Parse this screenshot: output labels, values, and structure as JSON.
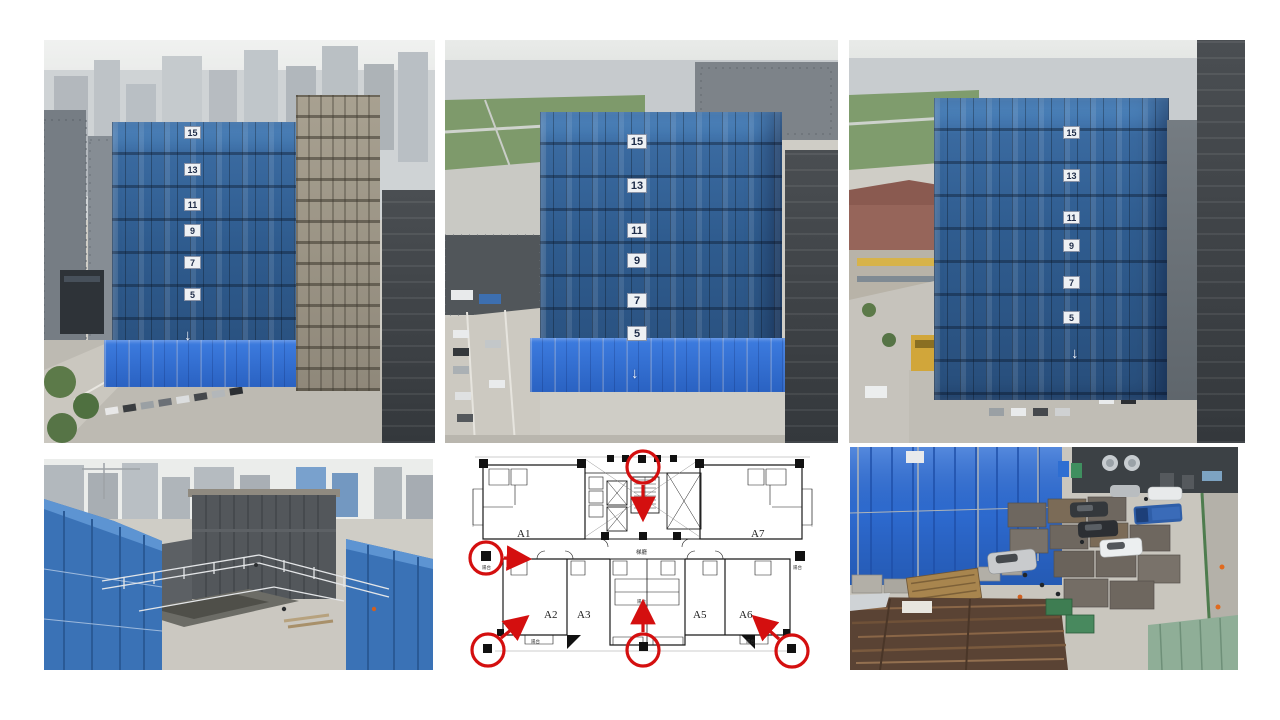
{
  "page": {
    "background": "#ffffff"
  },
  "photos": {
    "top_left": {
      "floor_signs": [
        "15",
        "13",
        "11",
        "9",
        "7",
        "5"
      ],
      "hoist_arrow": "↓"
    },
    "top_center": {
      "floor_signs": [
        "15",
        "13",
        "11",
        "9",
        "7",
        "5"
      ],
      "hoist_arrow": "↓",
      "podium_sign": "5"
    },
    "top_right": {
      "floor_signs": [
        "15",
        "13",
        "11",
        "9",
        "7",
        "5"
      ],
      "hoist_arrow": "↓"
    }
  },
  "floor_plan": {
    "unit_labels": [
      "A1",
      "A2",
      "A3",
      "A5",
      "A6",
      "A7"
    ],
    "lobby_label": "梯廳",
    "balcony_label": "陽台",
    "marker_color": "#d40f0f"
  },
  "colors": {
    "mesh_blue": "#35608f",
    "mesh_blue_light": "#5590cc",
    "tarp_blue": "#2f6fd6",
    "annotation_red": "#d40f0f",
    "concrete": "#cbc8c1"
  }
}
